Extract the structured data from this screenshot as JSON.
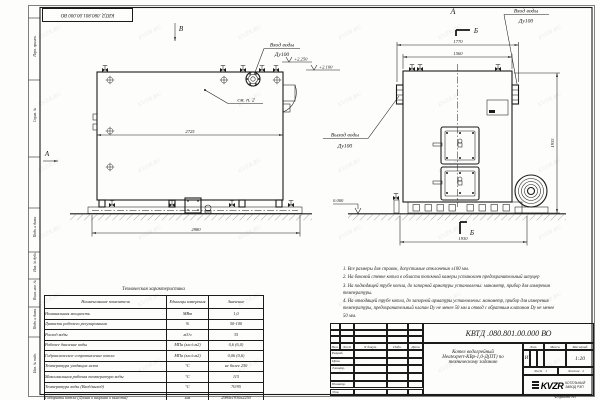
{
  "sheet": {
    "doc_number": "КВТД .080.801.00.000  ВО",
    "stamp_doc_number": "КВТД .080.801.00.000 ВО",
    "format_label": "Формат  А3",
    "watermark": "KVZR.RU"
  },
  "margin_labels": [
    "Перв. примен.",
    "Справ. №",
    "Подп. и дата",
    "Инв. № дубл.",
    "Взам. инв. №",
    "Подп. и дата",
    "Инв. № подл."
  ],
  "views": {
    "view_b": "В",
    "view_a_arrow": "А",
    "view_a_title": "А",
    "section_b_top": "Б",
    "section_b_bottom": "Б",
    "inlet_label": "Вход воды",
    "inlet_dn": "Ду100",
    "inlet2_label": "Вход воды",
    "inlet2_dn": "Ду100",
    "outlet_label": "Выход воды",
    "outlet_dn": "Ду100",
    "see_note": "см. п. 2",
    "elev_2250": "+2.250",
    "elev_2100": "+2.100",
    "elev_zero": "0.000",
    "dim_2725": "2725",
    "dim_2980": "2980",
    "dim_1770": "1770",
    "dim_1560": "1560",
    "dim_1930": "1930",
    "dim_height": "1935"
  },
  "notes": {
    "n1": "1. Все размеры для справок, допустимые отклонения ±100 мм.",
    "n2": "2. На боковой стенке котла в области топочной камеры установлен предохранительный штуцер",
    "n3": "3. На подводящей трубе котла, до запорной арматуры установлены: манометр, прибор для измерения температуры.",
    "n4": "4. На отводящей трубе котла, до запорной арматуры установлены: манометр, прибор для измерения температуры, предохранительный клапан Dу не менее 50 мм и отвод с обратным клапаном Dу не менее 50 мм."
  },
  "tech_table": {
    "title": "Техническая характеристика",
    "col_name": "Наименование показателя",
    "col_units": "Единицы измерения",
    "col_value": "Значение",
    "rows": [
      {
        "name": "Номинальная мощность",
        "units": "МВт",
        "value": "1,0"
      },
      {
        "name": "Диапазон рабочего регулирования",
        "units": "%",
        "value": "50-100"
      },
      {
        "name": "Расход воды",
        "units": "м3/ч",
        "value": "35"
      },
      {
        "name": "Рабочее давление воды",
        "units": "МПа (кгс/см2)",
        "value": "0,6 (6,0)"
      },
      {
        "name": "Гидравлическое сопротивление котла",
        "units": "МПа (кгс/см2)",
        "value": "0,06 (0,6)"
      },
      {
        "name": "Температура уходящих газов",
        "units": "°С",
        "value": "не более 250"
      },
      {
        "name": "Максимальная рабочая температура воды",
        "units": "°С",
        "value": "115"
      },
      {
        "name": "Температура воды (Вход/выход)",
        "units": "°С",
        "value": "70/95"
      },
      {
        "name": "Габариты котла (Длина х ширина х высота)",
        "units": "мм",
        "value": "2980х1930х2250"
      }
    ]
  },
  "title_block": {
    "doc_number": "КВТД .080.801.00.000  ВО",
    "name_line1": "Котел водогрейный",
    "name_line2": "Heatexpert-КВр-1,0-Д(ПТ) по",
    "name_line3": "техническому заданию",
    "h_izm": "Изм.",
    "h_list": "Лист",
    "h_ndoc": "N докум.",
    "h_podp": "Подп.",
    "h_data": "Дата",
    "r_razrab": "Разраб.",
    "r_prov": "Пров.",
    "r_tkontr": "Т.контр.",
    "r_nkontr": "Н.контр.",
    "r_utv": "Утв.",
    "lit_label": "Лит.",
    "mass_label": "Масса",
    "scale_label": "Масштаб",
    "lit_value": "И",
    "scale_value": "1:20",
    "sheet_label": "Лист",
    "sheet_value": "1",
    "sheets_label": "Листов",
    "sheets_value": "2",
    "logo_text": "KVZR",
    "logo_sub1": "КОТЕЛЬНЫЙ",
    "logo_sub2": "ЗАВОД РЭП"
  }
}
